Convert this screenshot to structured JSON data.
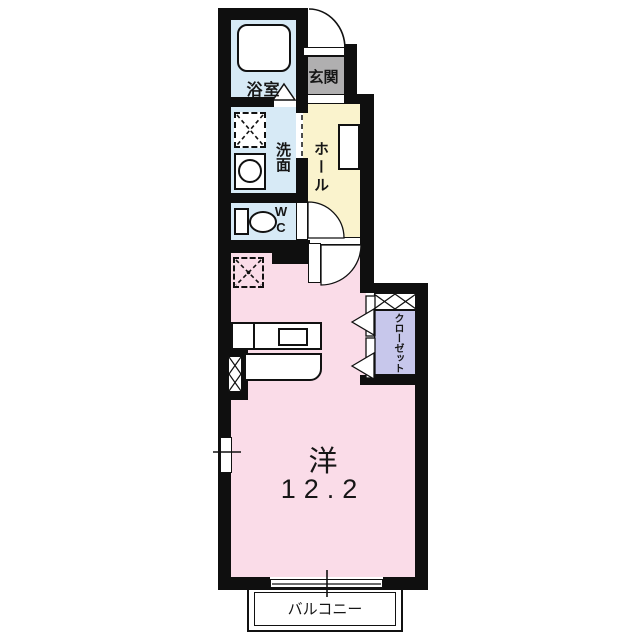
{
  "rooms": {
    "bathroom": {
      "label": "浴室"
    },
    "washroom": {
      "label": "洗面"
    },
    "wc": {
      "label": "WC",
      "line1": "W",
      "line2": "C"
    },
    "entrance": {
      "label": "玄関"
    },
    "hall": {
      "label": "ホール"
    },
    "closet": {
      "label": "クローゼット"
    },
    "main_room": {
      "label": "洋",
      "size": "12.2"
    },
    "balcony": {
      "label": "バルコニー"
    }
  },
  "colors": {
    "wall": "#0f0f0f",
    "wet_area": "#d7eaf6",
    "hall": "#faf3cd",
    "main_room": "#fadce8",
    "closet": "#c7c7eb",
    "entrance": "#b0afb0"
  }
}
